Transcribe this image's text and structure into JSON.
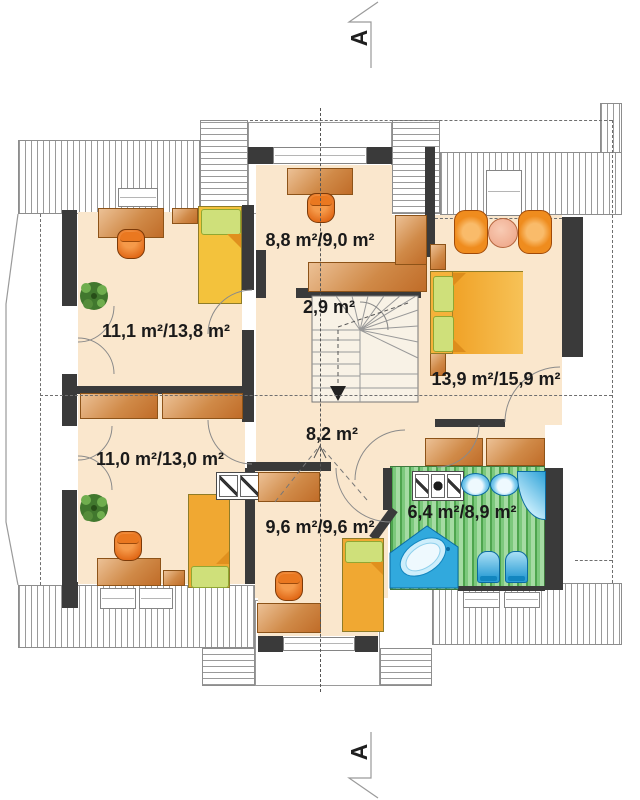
{
  "drawing": "attic floor plan",
  "section_markers": {
    "top": "A",
    "bottom": "A"
  },
  "rooms": [
    {
      "id": "room-top-middle",
      "area_label": "8,8 m²/9,0 m²"
    },
    {
      "id": "staircase",
      "area_label": "2,9 m²"
    },
    {
      "id": "room-top-left",
      "area_label": "11,1 m²/13,8 m²"
    },
    {
      "id": "bedroom-top-right",
      "area_label": "13,9 m²/15,9 m²"
    },
    {
      "id": "hall",
      "area_label": "8,2 m²"
    },
    {
      "id": "room-bottom-left",
      "area_label": "11,0 m²/13,0 m²"
    },
    {
      "id": "room-bottom-middle",
      "area_label": "9,6 m²/9,6 m²"
    },
    {
      "id": "bathroom",
      "area_label": "6,4 m²/8,9 m²"
    }
  ],
  "colors": {
    "wall": "#3a3a3a",
    "floor": "#fae7cd",
    "wood_furniture": "#c9752f",
    "bed_yellow": "#f3c23c",
    "bed_orange": "#f0a832",
    "pillow_green": "#cfe07a",
    "chair_orange": "#e06614",
    "fixture_blue": "#2fa9dd",
    "bathroom_floor_green": "#7cc87c",
    "roof_hatch": "#9a9a9a"
  }
}
